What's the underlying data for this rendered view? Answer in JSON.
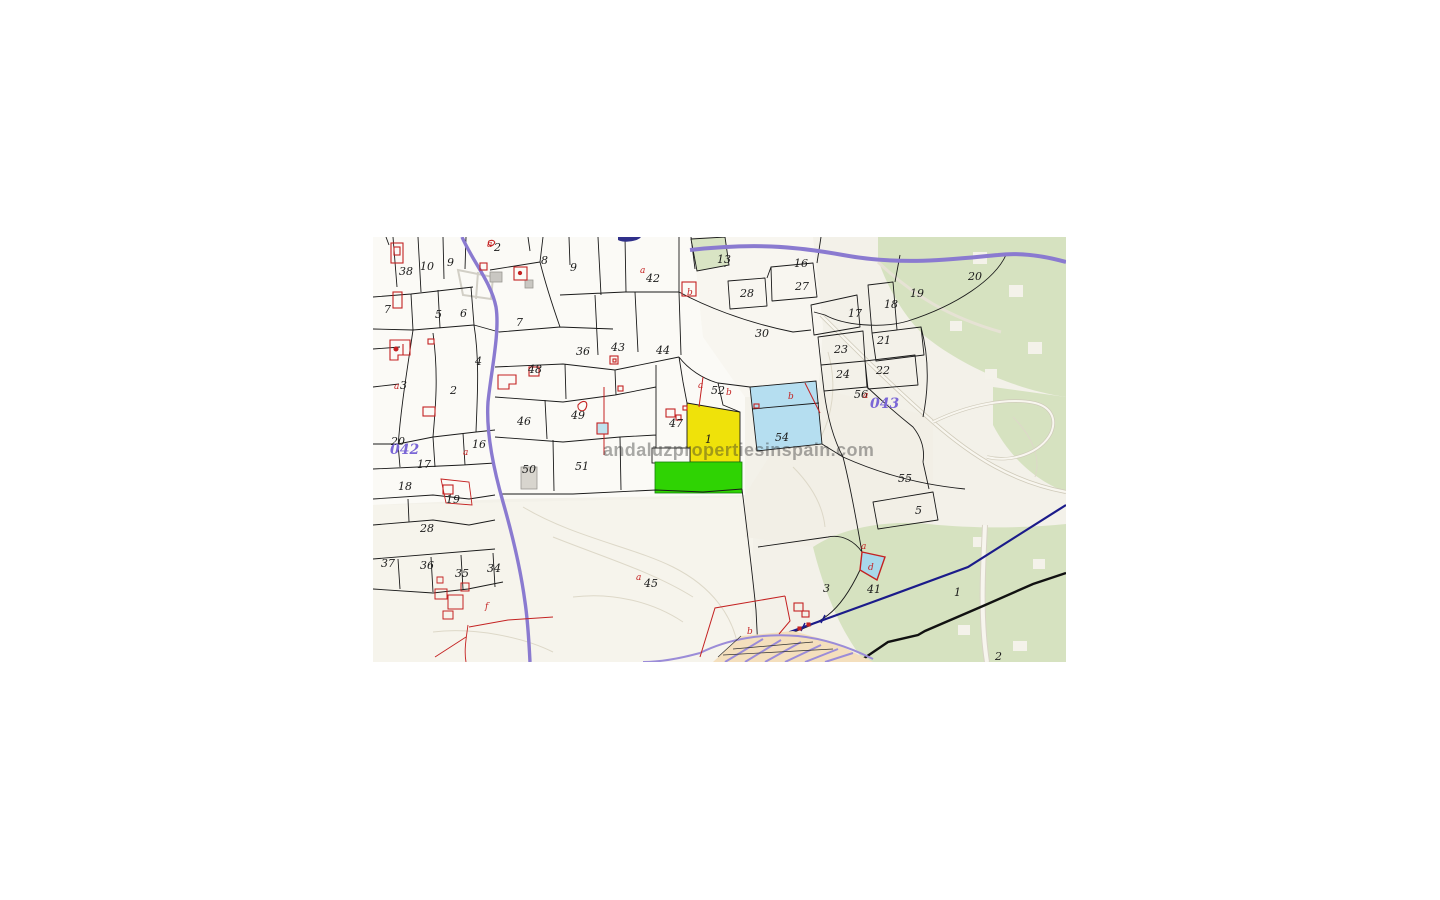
{
  "map": {
    "watermark_text": "andaluzpropertiesinspain.com",
    "colors": {
      "terrain_base": "#f3f1e9",
      "parcel_white": "#fbfaf6",
      "vegetation_green": "#d6e2c0",
      "highlight_yellow": "#efe20a",
      "highlight_green": "#2fd303",
      "highlight_blue": "#b5def0",
      "water_blue": "#a8d8ea",
      "road_purple": "#8a7ad0",
      "boundary_navy": "#1b1b8a",
      "cadastre_red": "#c42222",
      "sheet_purple": "#7a66d6",
      "urban_tan": "#f4dfbd",
      "contour_gray": "#ddd8c8"
    },
    "sheet_labels": [
      {
        "text": "042",
        "x": 17,
        "y": 217
      },
      {
        "text": "043",
        "x": 497,
        "y": 171
      }
    ],
    "parcel_labels": [
      {
        "text": "38",
        "x": 26,
        "y": 38
      },
      {
        "text": "10",
        "x": 47,
        "y": 33
      },
      {
        "text": "9",
        "x": 74,
        "y": 29
      },
      {
        "text": "2",
        "x": 121,
        "y": 14
      },
      {
        "text": "8",
        "x": 168,
        "y": 27
      },
      {
        "text": "9",
        "x": 197,
        "y": 34
      },
      {
        "text": "42",
        "x": 273,
        "y": 45
      },
      {
        "text": "13",
        "x": 344,
        "y": 26
      },
      {
        "text": "16",
        "x": 421,
        "y": 30
      },
      {
        "text": "27",
        "x": 422,
        "y": 53
      },
      {
        "text": "28",
        "x": 367,
        "y": 60
      },
      {
        "text": "17",
        "x": 475,
        "y": 80
      },
      {
        "text": "18",
        "x": 511,
        "y": 71
      },
      {
        "text": "19",
        "x": 537,
        "y": 60
      },
      {
        "text": "20",
        "x": 595,
        "y": 43
      },
      {
        "text": "30",
        "x": 382,
        "y": 100
      },
      {
        "text": "21",
        "x": 504,
        "y": 107
      },
      {
        "text": "23",
        "x": 461,
        "y": 116
      },
      {
        "text": "24",
        "x": 463,
        "y": 141
      },
      {
        "text": "22",
        "x": 503,
        "y": 137
      },
      {
        "text": "7",
        "x": 11,
        "y": 76
      },
      {
        "text": "5",
        "x": 62,
        "y": 81
      },
      {
        "text": "6",
        "x": 87,
        "y": 80
      },
      {
        "text": "7",
        "x": 143,
        "y": 89
      },
      {
        "text": "36",
        "x": 203,
        "y": 118
      },
      {
        "text": "43",
        "x": 238,
        "y": 114
      },
      {
        "text": "44",
        "x": 283,
        "y": 117
      },
      {
        "text": "4",
        "x": 102,
        "y": 128
      },
      {
        "text": "48",
        "x": 155,
        "y": 136
      },
      {
        "text": "2",
        "x": 77,
        "y": 157
      },
      {
        "text": "3",
        "x": 27,
        "y": 152
      },
      {
        "text": "46",
        "x": 144,
        "y": 188
      },
      {
        "text": "49",
        "x": 198,
        "y": 182
      },
      {
        "text": "47",
        "x": 296,
        "y": 190
      },
      {
        "text": "52",
        "x": 338,
        "y": 157
      },
      {
        "text": "1",
        "x": 332,
        "y": 206
      },
      {
        "text": "54",
        "x": 402,
        "y": 204
      },
      {
        "text": "56",
        "x": 481,
        "y": 161
      },
      {
        "text": "20",
        "x": 18,
        "y": 208
      },
      {
        "text": "16",
        "x": 99,
        "y": 211
      },
      {
        "text": "17",
        "x": 44,
        "y": 231
      },
      {
        "text": "50",
        "x": 149,
        "y": 236
      },
      {
        "text": "51",
        "x": 202,
        "y": 233
      },
      {
        "text": "18",
        "x": 25,
        "y": 253
      },
      {
        "text": "19",
        "x": 73,
        "y": 266
      },
      {
        "text": "28",
        "x": 47,
        "y": 295
      },
      {
        "text": "55",
        "x": 525,
        "y": 245
      },
      {
        "text": "5",
        "x": 542,
        "y": 277
      },
      {
        "text": "37",
        "x": 8,
        "y": 330
      },
      {
        "text": "36",
        "x": 47,
        "y": 332
      },
      {
        "text": "35",
        "x": 82,
        "y": 340
      },
      {
        "text": "34",
        "x": 114,
        "y": 335
      },
      {
        "text": "45",
        "x": 271,
        "y": 350
      },
      {
        "text": "3",
        "x": 450,
        "y": 355
      },
      {
        "text": "41",
        "x": 494,
        "y": 356
      },
      {
        "text": "1",
        "x": 581,
        "y": 359
      },
      {
        "text": "2",
        "x": 622,
        "y": 423
      }
    ],
    "subdivision_labels": [
      {
        "text": "a",
        "x": 114,
        "y": 10
      },
      {
        "text": "a",
        "x": 267,
        "y": 36
      },
      {
        "text": "b",
        "x": 314,
        "y": 58
      },
      {
        "text": "a",
        "x": 325,
        "y": 151
      },
      {
        "text": "b",
        "x": 353,
        "y": 158
      },
      {
        "text": "b",
        "x": 415,
        "y": 162
      },
      {
        "text": "a",
        "x": 490,
        "y": 161
      },
      {
        "text": "a",
        "x": 21,
        "y": 152
      },
      {
        "text": "a",
        "x": 90,
        "y": 218
      },
      {
        "text": "a",
        "x": 263,
        "y": 343
      },
      {
        "text": "f",
        "x": 112,
        "y": 372
      },
      {
        "text": "b",
        "x": 374,
        "y": 397
      },
      {
        "text": "d",
        "x": 495,
        "y": 333
      },
      {
        "text": "a",
        "x": 488,
        "y": 312
      }
    ]
  }
}
